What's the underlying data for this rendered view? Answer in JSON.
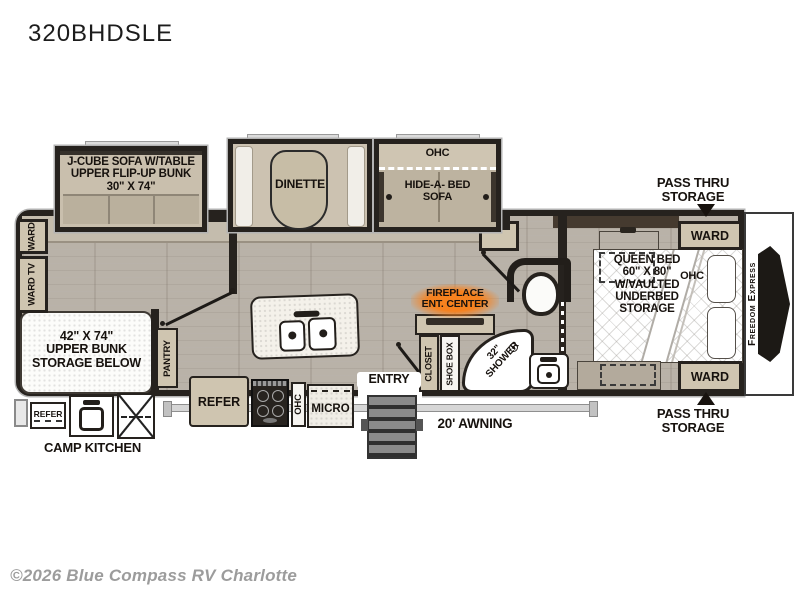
{
  "page": {
    "title": "320BHDSLE",
    "copyright": "©2026 Blue Compass RV Charlotte"
  },
  "plan": {
    "brand": "Freedom Express",
    "slideouts": {
      "sofa_bunk": "J-CUBE SOFA W/TABLE\nUPPER FLIP-UP BUNK\n30\" X 74\"",
      "dinette": "DINETTE",
      "ohc": "OHC",
      "hide_a_bed_sofa": "HIDE-A- BED\nSOFA"
    },
    "bedroom": {
      "pass_thru_top": "PASS THRU\nSTORAGE",
      "pass_thru_bottom": "PASS THRU\nSTORAGE",
      "ward_top": "WARD",
      "ward_bottom": "WARD",
      "queen_bed": "QUEEN BED\n60\" X 80\"\nW/VAULTED\nUNDERBED\nSTORAGE",
      "ohc": "OHC"
    },
    "bathroom": {
      "fireplace_ent_center": "FIREPLACE\nENT. CENTER",
      "closet": "CLOSET",
      "shoe_box": "SHOE BOX",
      "shower": "32\"\nSHOWER"
    },
    "bunkhouse": {
      "ward": "WARD",
      "ward_tv": "WARD TV",
      "upper_bunk": "42\" X 74\"\nUPPER BUNK\nSTORAGE BELOW",
      "pantry": "PANTRY"
    },
    "kitchen": {
      "refer": "REFER",
      "ohc": "OHC",
      "micro": "MICRO"
    },
    "exterior": {
      "entry": "ENTRY",
      "awning": "20' AWNING",
      "camp_kitchen": "CAMP KITCHEN",
      "camp_refer": "REFER"
    }
  }
}
